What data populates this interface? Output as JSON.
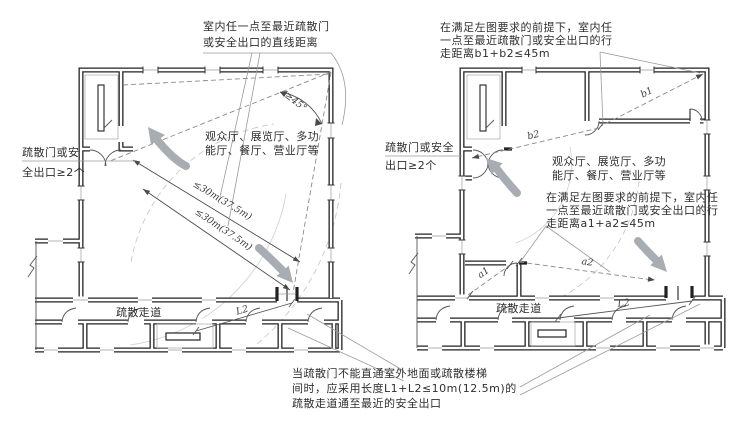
{
  "figure": {
    "background": "#ffffff",
    "wall_color": "#222222",
    "arrow_color": "#a8adb3",
    "annotation_color": "#2f2f2f"
  },
  "left_plan": {
    "annotation_top": {
      "line1": "室内任一点至最近疏散门",
      "line2": "或安全出口的直线距离"
    },
    "annotation_left": {
      "line1": "疏散门或安",
      "line2": "全出口≥2个"
    },
    "room_label": {
      "line1": "观众厅、展览厅、多功",
      "line2": "能厅、餐厅、营业厅等"
    },
    "corridor_label": "疏散走道",
    "angle_label": "≥45°",
    "distance_labels": [
      "≤30m(37.5m)",
      "≤30m(37.5m)"
    ],
    "l2_label": "L2"
  },
  "right_plan": {
    "annotation_top": {
      "line1": "在满足左图要求的前提下，室内任",
      "line2": "一点至最近疏散门或安全出口的行",
      "line3": "走距离b1+b2≤45m"
    },
    "annotation_left": {
      "line1": "疏散门或安全",
      "line2": "出口≥2个"
    },
    "annotation_mid": {
      "line1": "在满足左图要求的前提下，室内任",
      "line2": "一点至最近疏散门或安全出口的行",
      "line3": "走距离a1+a2≤45m"
    },
    "room_label": {
      "line1": "观众厅、展览厅、多功",
      "line2": "能厅、餐厅、营业厅等"
    },
    "corridor_label": "疏散走道",
    "b1_label": "b1",
    "b2_label": "b2",
    "a1_label": "a1",
    "a2_label": "a2",
    "l2_label": "L2"
  },
  "footnote": {
    "line1": "当疏散门不能直通室外地面或疏散楼梯",
    "line2": "间时，应采用长度L1+L2≤10m(12.5m)的",
    "line3": "疏散走道通至最近的安全出口"
  }
}
